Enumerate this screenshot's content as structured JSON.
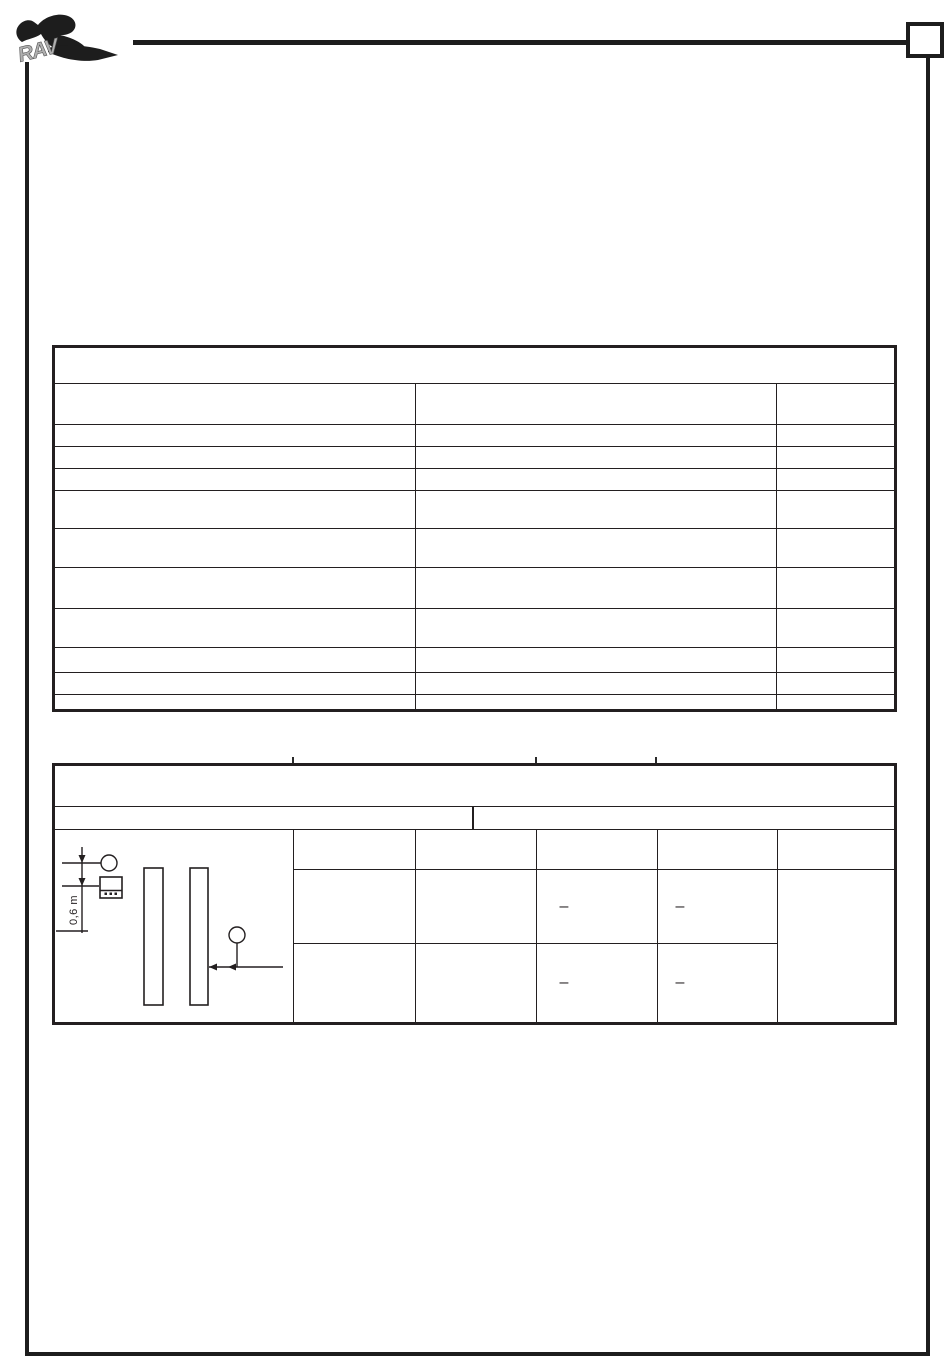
{
  "page": {
    "logo_text": "RAV",
    "page_number_box_value": ""
  },
  "table2": {
    "diagram": {
      "dimension_label": "0,6 m"
    },
    "rows": [
      {
        "col3": "–",
        "col4": "–"
      },
      {
        "col3": "–",
        "col4": "–"
      }
    ]
  }
}
